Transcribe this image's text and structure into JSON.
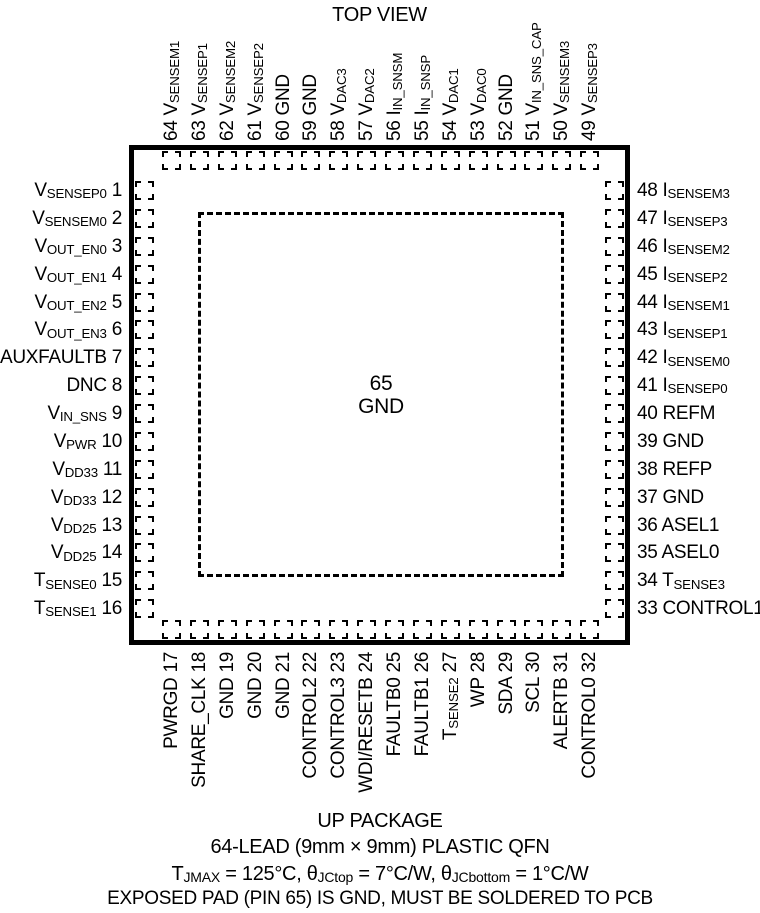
{
  "title": "TOP VIEW",
  "package": {
    "center_pin": {
      "number": "65",
      "label": "GND"
    }
  },
  "pins": {
    "left": [
      {
        "n": 1,
        "label": "V~SENSEP0~"
      },
      {
        "n": 2,
        "label": "V~SENSEM0~"
      },
      {
        "n": 3,
        "label": "V~OUT_EN0~"
      },
      {
        "n": 4,
        "label": "V~OUT_EN1~"
      },
      {
        "n": 5,
        "label": "V~OUT_EN2~"
      },
      {
        "n": 6,
        "label": "V~OUT_EN3~"
      },
      {
        "n": 7,
        "label": "AUXFAULTB"
      },
      {
        "n": 8,
        "label": "DNC"
      },
      {
        "n": 9,
        "label": "V~IN_SNS~"
      },
      {
        "n": 10,
        "label": "V~PWR~"
      },
      {
        "n": 11,
        "label": "V~DD33~"
      },
      {
        "n": 12,
        "label": "V~DD33~"
      },
      {
        "n": 13,
        "label": "V~DD25~"
      },
      {
        "n": 14,
        "label": "V~DD25~"
      },
      {
        "n": 15,
        "label": "T~SENSE0~"
      },
      {
        "n": 16,
        "label": "T~SENSE1~"
      }
    ],
    "top": [
      {
        "n": 64,
        "label": "V~SENSEM1~"
      },
      {
        "n": 63,
        "label": "V~SENSEP1~"
      },
      {
        "n": 62,
        "label": "V~SENSEM2~"
      },
      {
        "n": 61,
        "label": "V~SENSEP2~"
      },
      {
        "n": 60,
        "label": "GND"
      },
      {
        "n": 59,
        "label": "GND"
      },
      {
        "n": 58,
        "label": "V~DAC3~"
      },
      {
        "n": 57,
        "label": "V~DAC2~"
      },
      {
        "n": 56,
        "label": "I~IN_SNSM~"
      },
      {
        "n": 55,
        "label": "I~IN_SNSP~"
      },
      {
        "n": 54,
        "label": "V~DAC1~"
      },
      {
        "n": 53,
        "label": "V~DAC0~"
      },
      {
        "n": 52,
        "label": "GND"
      },
      {
        "n": 51,
        "label": "V~IN_SNS_CAP~"
      },
      {
        "n": 50,
        "label": "V~SENSEM3~"
      },
      {
        "n": 49,
        "label": "V~SENSEP3~"
      }
    ],
    "right": [
      {
        "n": 48,
        "label": "I~SENSEM3~"
      },
      {
        "n": 47,
        "label": "I~SENSEP3~"
      },
      {
        "n": 46,
        "label": "I~SENSEM2~"
      },
      {
        "n": 45,
        "label": "I~SENSEP2~"
      },
      {
        "n": 44,
        "label": "I~SENSEM1~"
      },
      {
        "n": 43,
        "label": "I~SENSEP1~"
      },
      {
        "n": 42,
        "label": "I~SENSEM0~"
      },
      {
        "n": 41,
        "label": "I~SENSEP0~"
      },
      {
        "n": 40,
        "label": "REFM"
      },
      {
        "n": 39,
        "label": "GND"
      },
      {
        "n": 38,
        "label": "REFP"
      },
      {
        "n": 37,
        "label": "GND"
      },
      {
        "n": 36,
        "label": "ASEL1"
      },
      {
        "n": 35,
        "label": "ASEL0"
      },
      {
        "n": 34,
        "label": "T~SENSE3~"
      },
      {
        "n": 33,
        "label": "CONTROL1"
      }
    ],
    "bottom": [
      {
        "n": 17,
        "label": "PWRGD"
      },
      {
        "n": 18,
        "label": "SHARE_CLK"
      },
      {
        "n": 19,
        "label": "GND"
      },
      {
        "n": 20,
        "label": "GND"
      },
      {
        "n": 21,
        "label": "GND"
      },
      {
        "n": 22,
        "label": "CONTROL2"
      },
      {
        "n": 23,
        "label": "CONTROL3"
      },
      {
        "n": 24,
        "label": "WDI/RESETB"
      },
      {
        "n": 25,
        "label": "FAULTB0"
      },
      {
        "n": 26,
        "label": "FAULTB1"
      },
      {
        "n": 27,
        "label": "T~SENSE2~"
      },
      {
        "n": 28,
        "label": "WP"
      },
      {
        "n": 29,
        "label": "SDA"
      },
      {
        "n": 30,
        "label": "SCL"
      },
      {
        "n": 31,
        "label": "ALERTB"
      },
      {
        "n": 32,
        "label": "CONTROL0"
      }
    ]
  },
  "footer": {
    "line1": "UP PACKAGE",
    "line2": "64-LEAD (9mm × 9mm) PLASTIC QFN",
    "line3": "T~JMAX~ = 125°C, θ~JCtop~ = 7°C/W, θ~JCbottom~ = 1°C/W",
    "line4": "EXPOSED PAD (PIN 65) IS GND, MUST BE SOLDERED TO PCB"
  },
  "colors": {
    "ink": "#000000",
    "background": "#ffffff"
  }
}
